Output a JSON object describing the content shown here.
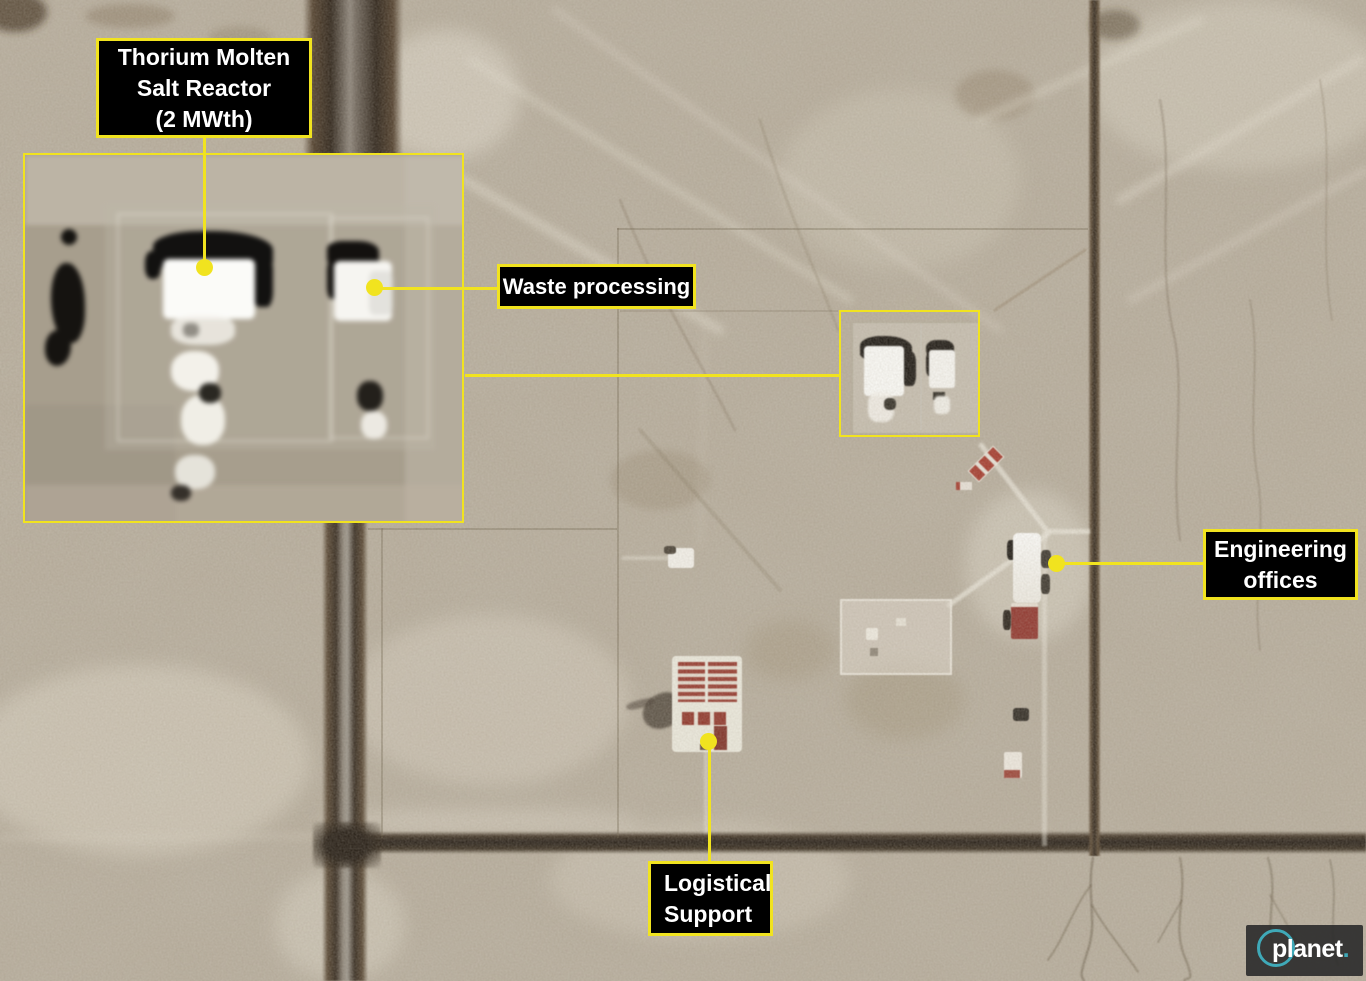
{
  "annotations": {
    "reactor": {
      "text": "Thorium Molten\nSalt Reactor\n(2 MWth)"
    },
    "waste": {
      "text": "Waste processing"
    },
    "engineering": {
      "text": "Engineering\noffices"
    },
    "logistics": {
      "text": "Logistical\nSupport"
    }
  },
  "attribution": {
    "brand": "planet",
    "suffix": "."
  },
  "colors": {
    "annotation_yellow": "#f1e31f",
    "label_background": "#000000",
    "label_text": "#ffffff",
    "planet_teal": "#3fa9b8",
    "terrain_base": "#b7ae9e",
    "road_dark": "#2c2217"
  }
}
